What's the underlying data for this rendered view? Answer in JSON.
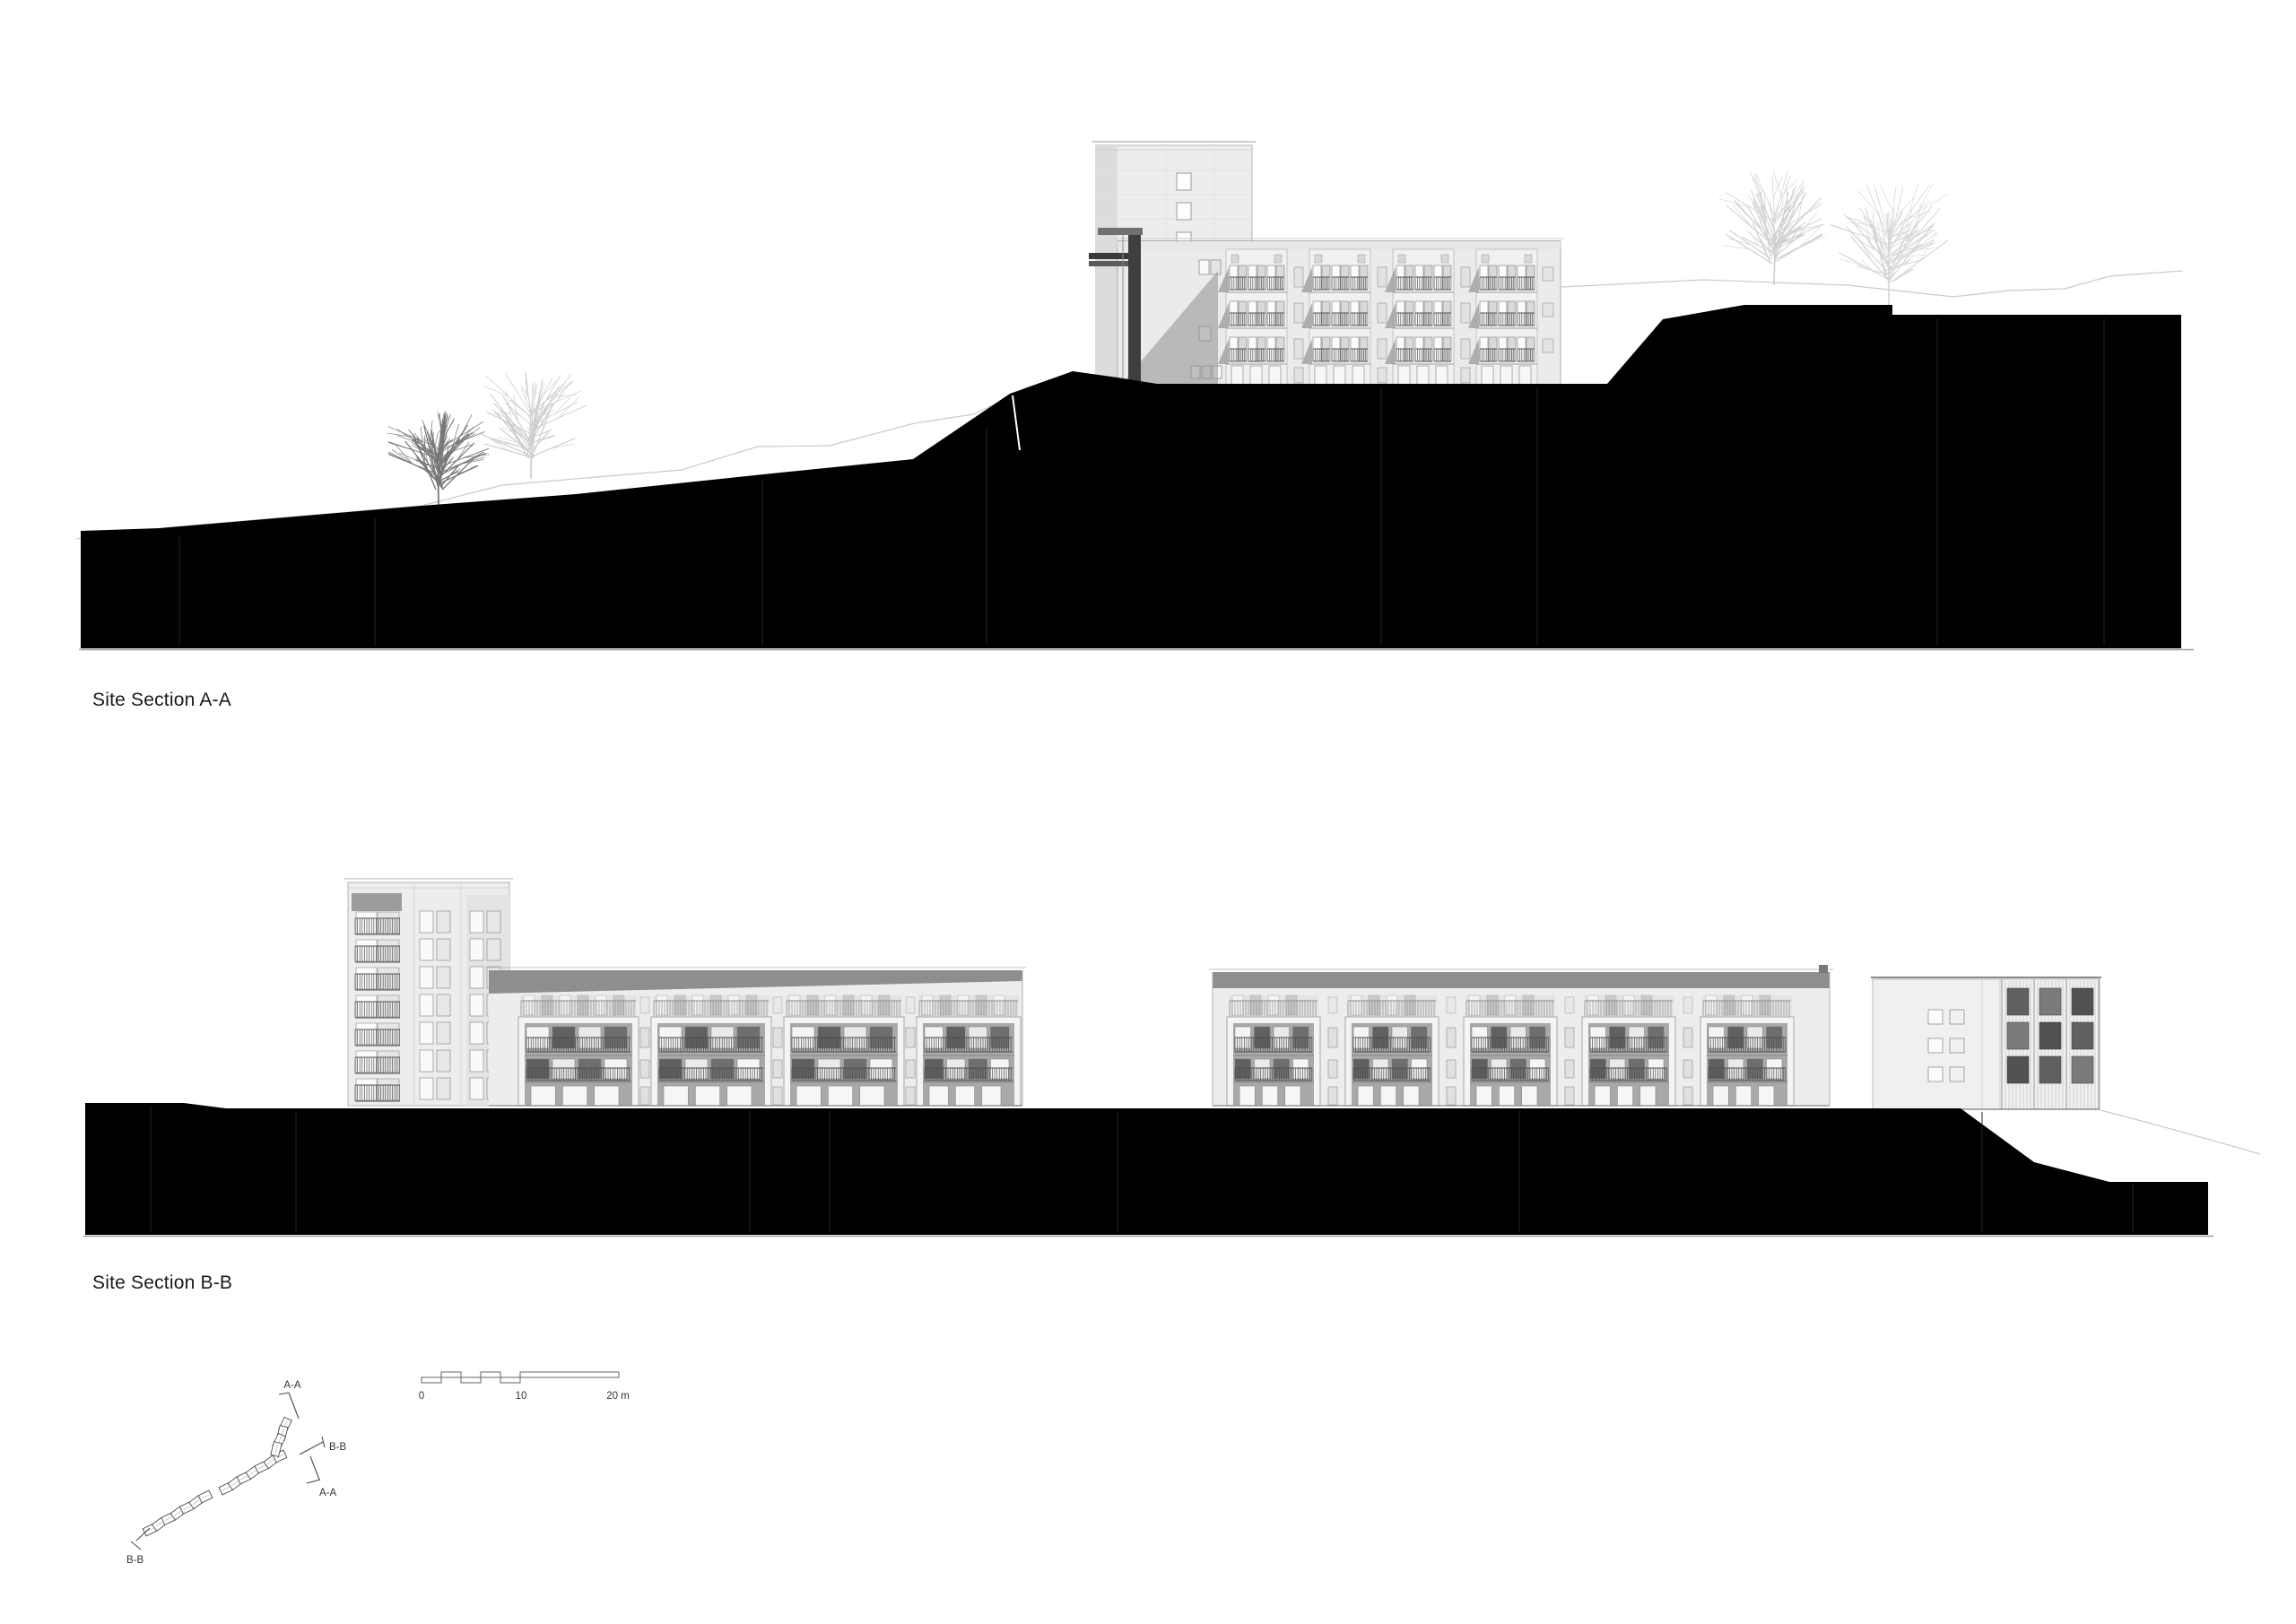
{
  "sections": {
    "a": {
      "title": "Site Section A-A"
    },
    "b": {
      "title": "Site Section B-B"
    }
  },
  "scale_bar": {
    "labels": {
      "zero": "0",
      "ten": "10",
      "twenty": "20 m"
    }
  },
  "key_plan": {
    "labels": {
      "aa_top": "A-A",
      "bb_right": "B-B",
      "aa_bottom": "A-A",
      "bb_left": "B-B"
    }
  },
  "colors": {
    "paper": "#ffffff",
    "poche": "#000000",
    "ink": "#1c1c1c",
    "faint_line": "#cbcbcb",
    "facade": "#ededed",
    "facade_bright": "#f4f4f4",
    "recess": "#a9a9a9",
    "roof_band": "#8e8e8e",
    "shadow": "#9f9f9f",
    "railing": "#4e4e4e"
  }
}
